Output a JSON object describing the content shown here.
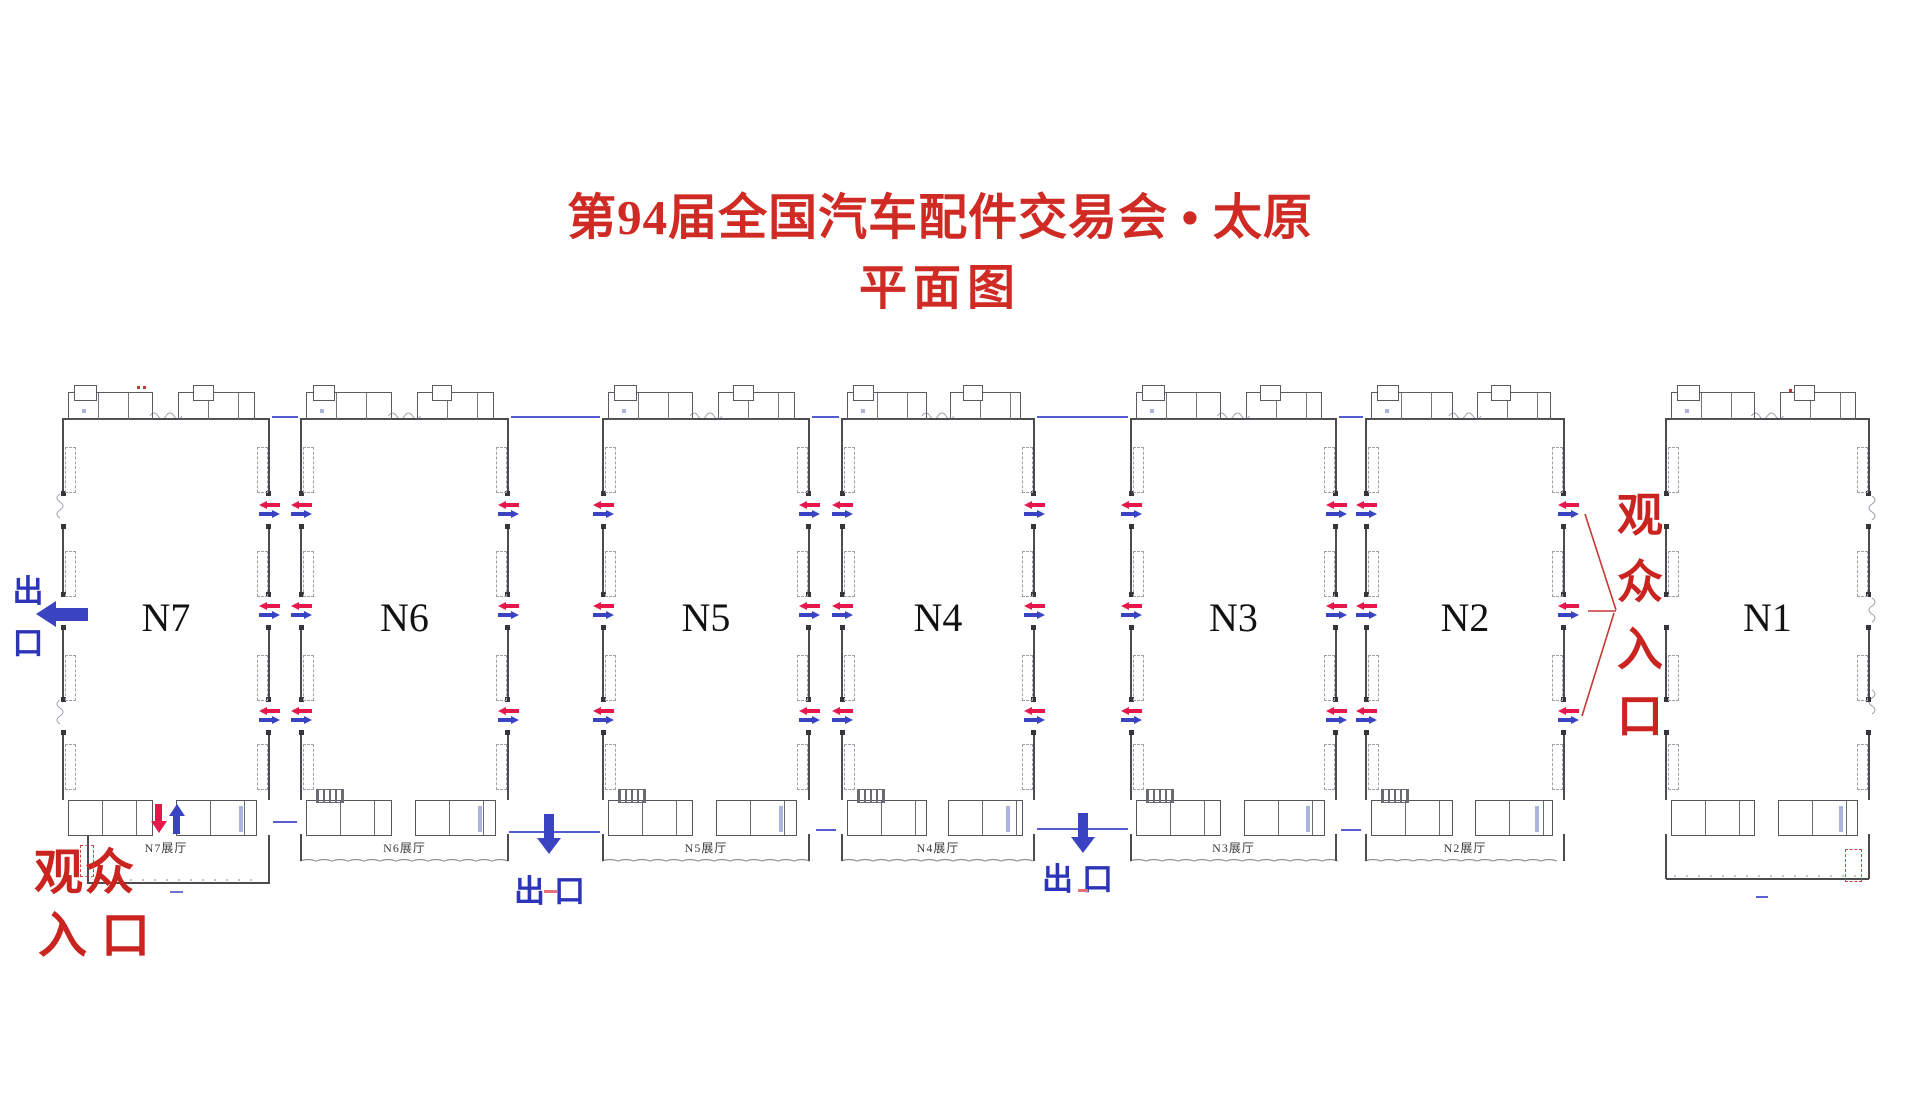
{
  "title": {
    "line1": "第94届全国汽车配件交易会 • 太原",
    "line2": "平面图"
  },
  "halls": [
    {
      "label": "N7",
      "bottom_label": "N7展厅"
    },
    {
      "label": "N6",
      "bottom_label": "N6展厅"
    },
    {
      "label": "N5",
      "bottom_label": "N5展厅"
    },
    {
      "label": "N4",
      "bottom_label": "N4展厅"
    },
    {
      "label": "N3",
      "bottom_label": "N3展厅"
    },
    {
      "label": "N2",
      "bottom_label": "N2展厅"
    },
    {
      "label": "N1",
      "bottom_label": ""
    }
  ],
  "exits": {
    "west": {
      "label": "出口",
      "orientation": "vertical"
    },
    "bottom_n6_n5": {
      "label": "出口"
    },
    "bottom_n4_n3": {
      "label": "出口"
    }
  },
  "entrances": {
    "southwest": {
      "line1": "观众",
      "line2": "入口"
    },
    "east": {
      "label": "观众入口",
      "orientation": "vertical"
    }
  },
  "icons": {
    "door_flow": [
      "red-arrow-left-icon",
      "blue-arrow-right-icon"
    ],
    "west_exit": "blue-arrow-left-icon",
    "bottom_exits": "blue-arrow-down-icon",
    "n7_gate": [
      "red-arrow-down-icon",
      "blue-arrow-up-icon"
    ]
  },
  "colors": {
    "title_red": "#cf2b24",
    "entrance_red": "#c9241f",
    "arrow_red": "#e8174b",
    "arrow_blue": "#3a43c2",
    "exit_text_blue": "#2c35b8",
    "connector_blue": "#3c46c8",
    "wall_dark": "#4b4b50",
    "wall_light": "#9aa0a8"
  }
}
